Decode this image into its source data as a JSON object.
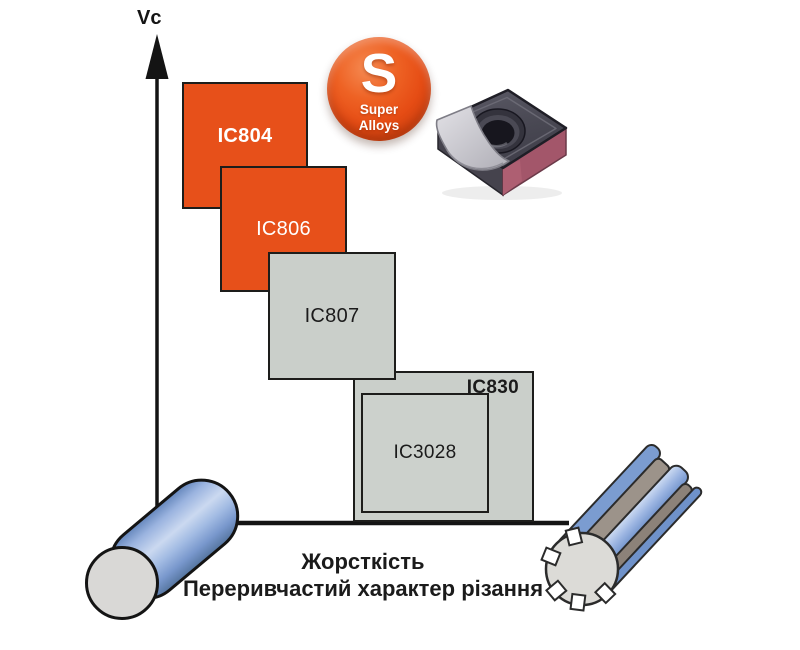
{
  "diagram": {
    "y_axis_label": "Vc",
    "x_axis_caption": [
      "Жорсткість",
      "Переривчастий характер різання"
    ],
    "grades": [
      {
        "label": "IC804",
        "color": "orange"
      },
      {
        "label": "IC806",
        "color": "orange"
      },
      {
        "label": "IC807",
        "color": "gray"
      },
      {
        "label": "IC830",
        "color": "gray"
      },
      {
        "label": "IC3028",
        "color": "gray"
      }
    ]
  },
  "badge": {
    "letter": "S",
    "lines": [
      "Super",
      "Alloys"
    ]
  },
  "colors": {
    "grade_orange": "#E7501A",
    "grade_gray": "#CACFCA",
    "badge_orange": "#E8541C",
    "workpiece_blue": "#7B9CD0",
    "workpiece_face_gray": "#D9D8D6",
    "spline_groove_gray": "#9C938A",
    "insert_top_gray": "#4B4A55",
    "insert_side_maroon": "#A3566A",
    "axis_black": "#141414"
  },
  "icons": {
    "insert": "carbide-insert-photo",
    "cylinder": "round-bar-workpiece",
    "splined_shaft": "splined-shaft-workpiece",
    "badge": "super-alloys-badge",
    "axis_arrow": "up-arrow"
  }
}
